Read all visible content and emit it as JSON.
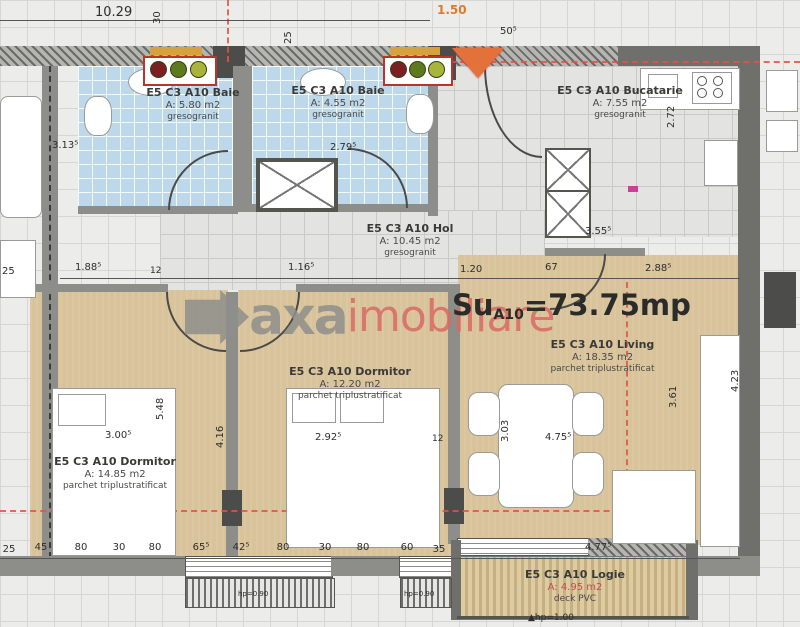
{
  "total": {
    "su": "Su",
    "sub": "A10",
    "value": "=73.75mp"
  },
  "watermark": {
    "part1": "axa",
    "part2": "imobiliare"
  },
  "rooms": [
    {
      "id": "baie-1",
      "name": "E5 C3 A10 Baie",
      "area": "A: 5.80 m2",
      "finish": "gresogranit"
    },
    {
      "id": "baie-2",
      "name": "E5 C3 A10 Baie",
      "area": "A: 4.55 m2",
      "finish": "gresogranit"
    },
    {
      "id": "bucatarie",
      "name": "E5 C3 A10 Bucatarie",
      "area": "A: 7.55 m2",
      "finish": "gresogranit"
    },
    {
      "id": "hol",
      "name": "E5 C3 A10 Hol",
      "area": "A: 10.45 m2",
      "finish": "gresogranit"
    },
    {
      "id": "dormitor-1",
      "name": "E5 C3 A10 Dormitor",
      "area": "A: 14.85 m2",
      "finish": "parchet triplustratificat"
    },
    {
      "id": "dormitor-2",
      "name": "E5 C3 A10 Dormitor",
      "area": "A: 12.20 m2",
      "finish": "parchet triplustratificat"
    },
    {
      "id": "living",
      "name": "E5 C3 A10 Living",
      "area": "A: 18.35 m2",
      "finish": "parchet triplustratificat"
    },
    {
      "id": "logie",
      "name": "E5 C3 A10 Logie",
      "area": "A: 4.95 m2",
      "finish": "deck PVC"
    }
  ],
  "dims": {
    "top_width": "10.29",
    "top_150": "1.50",
    "top_50": "50⁵",
    "top_30": "30",
    "top_25": "25",
    "baie1_w": "3.13⁵",
    "baie2_w": "2.79⁵",
    "buc_w": "3.55⁵",
    "buc_h": "2.72",
    "left_25": "25",
    "d188": "1.88⁵",
    "d12a": "12",
    "d116": "1.16⁵",
    "d120": "1.20",
    "d67": "67",
    "d288": "2.88⁵",
    "dorm1_w": "3.00⁵",
    "dorm1_h": "5.48",
    "dorm2_w": "2.92⁵",
    "dorm2_h": "4.16",
    "d12b": "12",
    "liv_303": "3.03",
    "liv_475": "4.75⁵",
    "liv_361": "3.61",
    "liv_423": "4.23",
    "logie_w": "4.77⁵",
    "logie_hp": "▲hp=1.00",
    "win_hp": "hp=0.90",
    "chain": [
      "25",
      "45",
      "80",
      "30",
      "80",
      "65⁵",
      "42⁵",
      "80",
      "30",
      "80",
      "60",
      "35"
    ]
  }
}
